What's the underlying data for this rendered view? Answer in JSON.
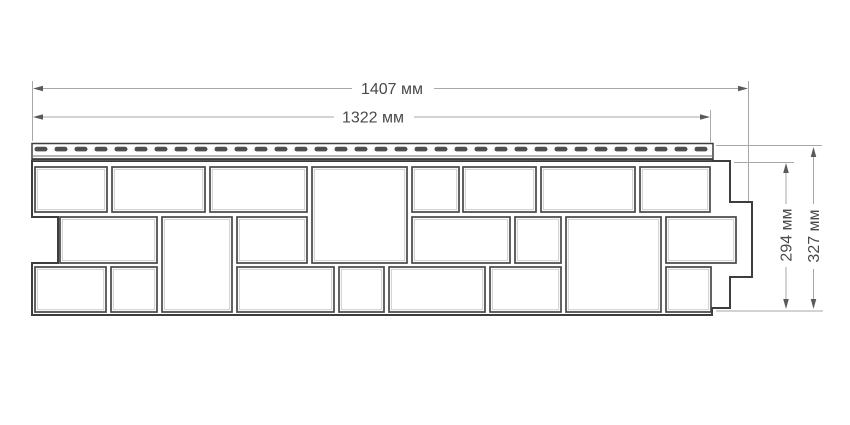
{
  "drawing": {
    "canvas": {
      "width": 850,
      "height": 425,
      "background": "#ffffff"
    },
    "colors": {
      "outline": "#3d3d3d",
      "block_stroke": "#474747",
      "block_inner": "#c9c9c9",
      "block_fill": "#ffffff",
      "slot_fill": "#4f4f4f",
      "dim_line": "#a6a9a9",
      "dim_arrow": "#5a5a5a",
      "dim_text": "#4a4a4a"
    },
    "panel": {
      "outline_points": [
        [
          32,
          161
        ],
        [
          730,
          161
        ],
        [
          730,
          202
        ],
        [
          752,
          202
        ],
        [
          752,
          277
        ],
        [
          730,
          277
        ],
        [
          730,
          308
        ],
        [
          712,
          308
        ],
        [
          712,
          315
        ],
        [
          32,
          315
        ],
        [
          32,
          263
        ],
        [
          58,
          263
        ],
        [
          58,
          217
        ],
        [
          32,
          217
        ]
      ],
      "nail_strip": {
        "x": 32,
        "y": 143.5,
        "width": 681,
        "height": 17.5,
        "inner_line_y": 156,
        "band_y": 159.2,
        "slots": {
          "start_x": 34.5,
          "y": 146.8,
          "width": 13,
          "height": 4.6,
          "pitch": 20,
          "count": 34
        }
      },
      "stone_blocks": [
        {
          "row": 1,
          "x": 35,
          "y": 167,
          "w": 72,
          "h": 45
        },
        {
          "row": 1,
          "x": 112,
          "y": 167,
          "w": 93,
          "h": 45
        },
        {
          "row": 1,
          "x": 210,
          "y": 167,
          "w": 97,
          "h": 45
        },
        {
          "row": 1,
          "x": 312,
          "y": 167,
          "w": 95,
          "h": 96
        },
        {
          "row": 1,
          "x": 412,
          "y": 167,
          "w": 47,
          "h": 45
        },
        {
          "row": 1,
          "x": 463,
          "y": 167,
          "w": 73,
          "h": 45
        },
        {
          "row": 1,
          "x": 541,
          "y": 167,
          "w": 94,
          "h": 45
        },
        {
          "row": 1,
          "x": 640,
          "y": 167,
          "w": 70,
          "h": 45
        },
        {
          "row": 2,
          "x": 60,
          "y": 217,
          "w": 97,
          "h": 46
        },
        {
          "row": 2,
          "x": 162,
          "y": 217,
          "w": 70,
          "h": 95
        },
        {
          "row": 2,
          "x": 237,
          "y": 217,
          "w": 70,
          "h": 46
        },
        {
          "row": 2,
          "x": 412,
          "y": 217,
          "w": 98,
          "h": 46
        },
        {
          "row": 2,
          "x": 515,
          "y": 217,
          "w": 46,
          "h": 46
        },
        {
          "row": 2,
          "x": 566,
          "y": 217,
          "w": 95,
          "h": 95
        },
        {
          "row": 2,
          "x": 666,
          "y": 217,
          "w": 70,
          "h": 46
        },
        {
          "row": 3,
          "x": 35,
          "y": 267,
          "w": 71,
          "h": 45
        },
        {
          "row": 3,
          "x": 111,
          "y": 267,
          "w": 46,
          "h": 45
        },
        {
          "row": 3,
          "x": 237,
          "y": 267,
          "w": 97,
          "h": 45
        },
        {
          "row": 3,
          "x": 339,
          "y": 267,
          "w": 45,
          "h": 45
        },
        {
          "row": 3,
          "x": 389,
          "y": 267,
          "w": 96,
          "h": 45
        },
        {
          "row": 3,
          "x": 490,
          "y": 267,
          "w": 71,
          "h": 45
        },
        {
          "row": 3,
          "x": 666,
          "y": 267,
          "w": 45,
          "h": 45
        }
      ]
    },
    "dimensions": [
      {
        "name": "panel-length-total",
        "label": "1407 мм",
        "orientation": "horizontal",
        "line_y": 88.5,
        "from_x": 33,
        "to_x": 748,
        "label_gap": [
          352,
          434
        ],
        "label_center": [
          392,
          88.5
        ],
        "extension_lines": [
          {
            "x": 32.5,
            "y1": 81,
            "y2": 141
          },
          {
            "x": 748.5,
            "y1": 81,
            "y2": 201
          }
        ]
      },
      {
        "name": "nail-strip-length",
        "label": "1322 мм",
        "orientation": "horizontal",
        "line_y": 117,
        "from_x": 33,
        "to_x": 710,
        "label_gap": [
          334,
          414
        ],
        "label_center": [
          373,
          117
        ],
        "extension_lines": [
          {
            "x": 710.5,
            "y1": 110,
            "y2": 142
          }
        ]
      },
      {
        "name": "panel-height",
        "label": "294 мм",
        "orientation": "vertical",
        "line_x": 786,
        "from_y": 163,
        "to_y": 309,
        "label_gap": [
          204,
          267
        ],
        "label_center": [
          786,
          235
        ],
        "extension_lines": [
          {
            "y": 162.5,
            "x1": 734,
            "x2": 794
          },
          {
            "y": 311,
            "x1": 716,
            "x2": 823
          }
        ]
      },
      {
        "name": "panel-height-total",
        "label": "327 мм",
        "orientation": "vertical",
        "line_x": 813.5,
        "from_y": 147,
        "to_y": 309,
        "label_gap": [
          204,
          269
        ],
        "label_center": [
          813.5,
          236
        ],
        "extension_lines": [
          {
            "y": 145.5,
            "x1": 716,
            "x2": 822
          }
        ]
      }
    ]
  }
}
